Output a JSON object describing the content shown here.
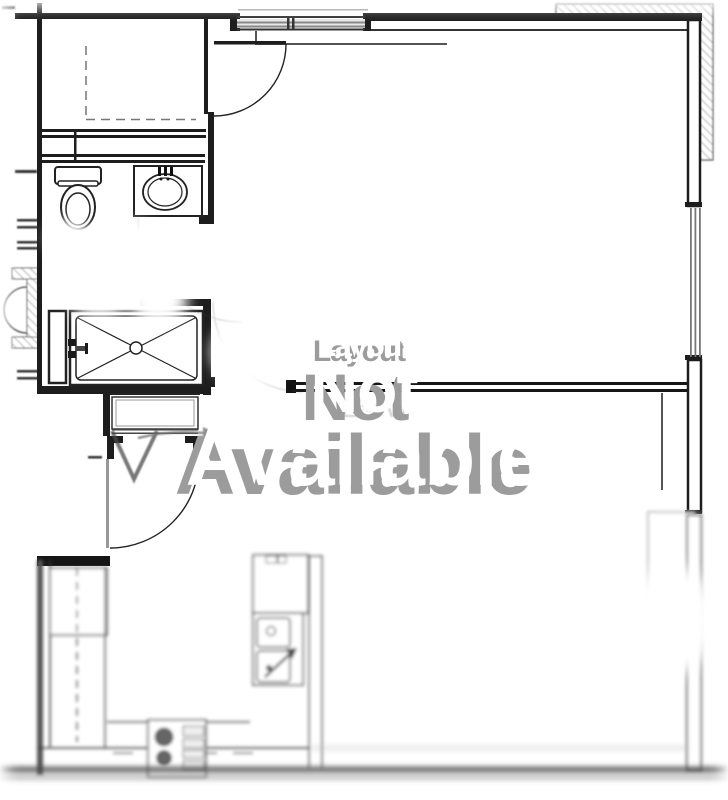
{
  "image": {
    "width": 728,
    "height": 800,
    "background": "#ffffff"
  },
  "watermark": {
    "line1": "Layout",
    "line2": "Not",
    "line3": "Available",
    "ghost_text": "Earvi",
    "text_color": "#ffffff",
    "shadow_color": "#9c9c9c"
  },
  "floorplan": {
    "kind": "apartment-unit floor plan line drawing, partially blurred",
    "line_color": "#1d1d1d",
    "hatch_color": "#999999",
    "fixtures": [
      "closet-with-dashed-rod",
      "toilet",
      "bathroom-sink-vanity",
      "shower-pan-x-pattern",
      "shower-valve",
      "interior-door-swing-top",
      "entry-door-swing",
      "entry-v-arrow-marker",
      "window-top",
      "window-right",
      "hatched-parapet-top-right",
      "refrigerator",
      "kitchen-double-sink",
      "range-two-burners",
      "kitchen-counter-dashed-upper-cabinets",
      "bottom-exterior-wall"
    ]
  }
}
